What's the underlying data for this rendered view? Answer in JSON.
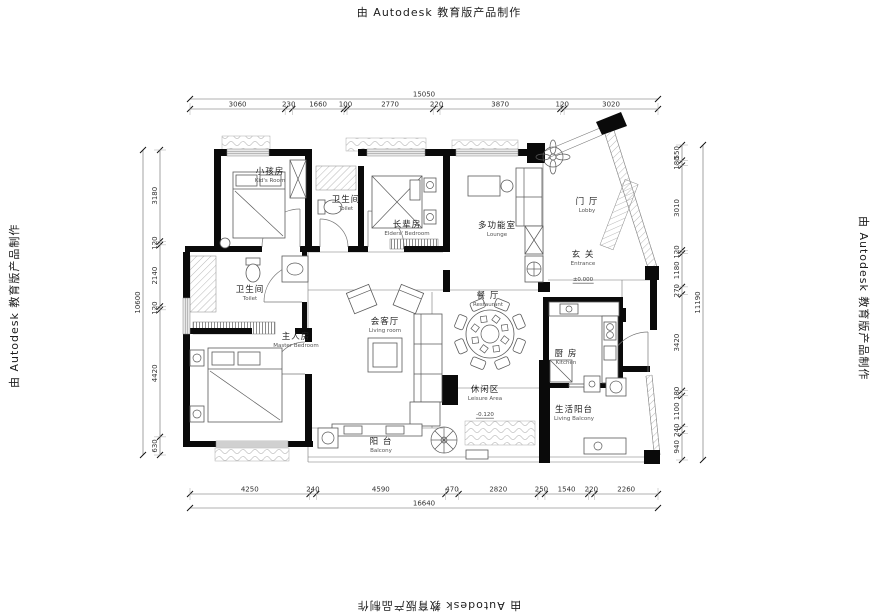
{
  "watermarks": {
    "top": "由 Autodesk 教育版产品制作",
    "bottom": "由 Autodesk 教育版产品制作",
    "left": "由 Autodesk 教育版产品制作",
    "right": "由 Autodesk 教育版产品制作"
  },
  "rooms": {
    "kids": {
      "zh": "小孩房",
      "en": "Kid's Room"
    },
    "toilet_top": {
      "zh": "卫生间",
      "en": "Toilet"
    },
    "elders": {
      "zh": "长辈房",
      "en": "Elders' Bedroom"
    },
    "lounge": {
      "zh": "多功能室",
      "en": "Lounge"
    },
    "lobby": {
      "zh": "门 厅",
      "en": "Lobby"
    },
    "entrance": {
      "zh": "玄 关",
      "en": "Entrance",
      "level": "±0.000"
    },
    "restaurant": {
      "zh": "餐 厅",
      "en": "Restaurant"
    },
    "living": {
      "zh": "会客厅",
      "en": "Living room"
    },
    "master_toilet": {
      "zh": "卫生间",
      "en": "Toilet"
    },
    "master": {
      "zh": "主人房",
      "en": "Master Bedroom"
    },
    "kitchen": {
      "zh": "厨 房",
      "en": "Kitchen"
    },
    "leisure": {
      "zh": "休闲区",
      "en": "Leisure Area",
      "level": "-0.120"
    },
    "living_balcony": {
      "zh": "生活阳台",
      "en": "Living Balcony"
    },
    "balcony": {
      "zh": "阳 台",
      "en": "Balcony"
    }
  },
  "dimensions": {
    "top": {
      "total": "15050",
      "segments": [
        "3060",
        "230",
        "1660",
        "100",
        "2770",
        "220",
        "3870",
        "120",
        "3020"
      ]
    },
    "bottom": {
      "total": "16640",
      "segments": [
        "4250",
        "240",
        "4590",
        "470",
        "2820",
        "250",
        "1540",
        "220",
        "2260"
      ]
    },
    "left": {
      "total": "10600",
      "segments": [
        "3180",
        "120",
        "2140",
        "120",
        "4420",
        "630"
      ]
    },
    "right": {
      "total": "11190",
      "segments": [
        "550",
        "180",
        "3010",
        "120",
        "1180",
        "270",
        "3420",
        "180",
        "1100",
        "240",
        "940"
      ]
    }
  }
}
